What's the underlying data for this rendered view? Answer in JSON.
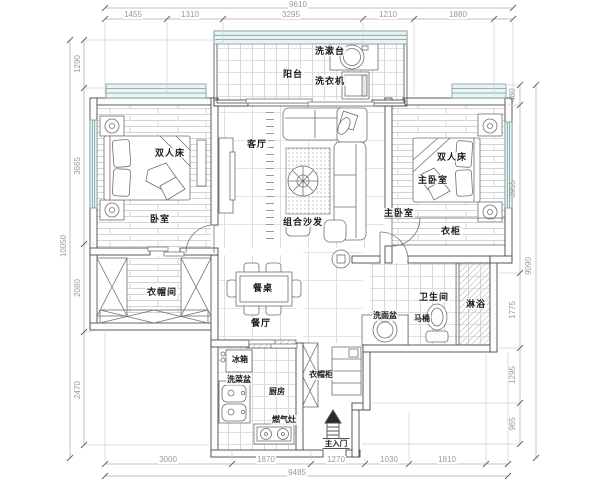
{
  "plan": {
    "rooms": {
      "balcony": "阳台",
      "living_room": "客厅",
      "bedroom": "卧室",
      "master_bedroom": "主卧室",
      "master_bedroom_entry": "主卧室",
      "cloakroom": "衣帽间",
      "dining_room": "餐厅",
      "kitchen": "厨房",
      "bathroom": "卫生间",
      "shower": "淋浴"
    },
    "fixtures": {
      "washstand": "洗漱台",
      "washing_machine": "洗衣机",
      "double_bed_left": "双人床",
      "double_bed_right": "双人床",
      "sofa": "组合沙发",
      "wardrobe": "衣柜",
      "dining_table": "餐桌",
      "fridge": "冰箱",
      "vegetable_sink": "洗菜盆",
      "gas_stove": "燃气灶",
      "coat_cabinet": "衣帽柜",
      "wash_basin": "洗面盆",
      "toilet": "马桶",
      "main_entrance": "主入门"
    },
    "dimensions": {
      "top_total": "9610",
      "top_segments": [
        "1455",
        "1310",
        "3295",
        "1210",
        "1880"
      ],
      "bottom_segments": [
        "3000",
        "1870",
        "1270",
        "1030",
        "1810"
      ],
      "bottom_total": "9485",
      "left_segments": [
        "1290",
        "3665",
        "2080",
        "2470"
      ],
      "left_total": "10050",
      "right_segments": [
        "480",
        "3955",
        "1775",
        "1295",
        "965"
      ],
      "right_total": "9090"
    },
    "colors": {
      "wall_line": "#4a4a4a",
      "furniture_line": "#6f6f6f",
      "hatch_line": "#c6c6c6",
      "dimension_text": "#9a9a9a",
      "label_text": "#1a1a1a",
      "window_fill": "#e9f5f5"
    }
  }
}
